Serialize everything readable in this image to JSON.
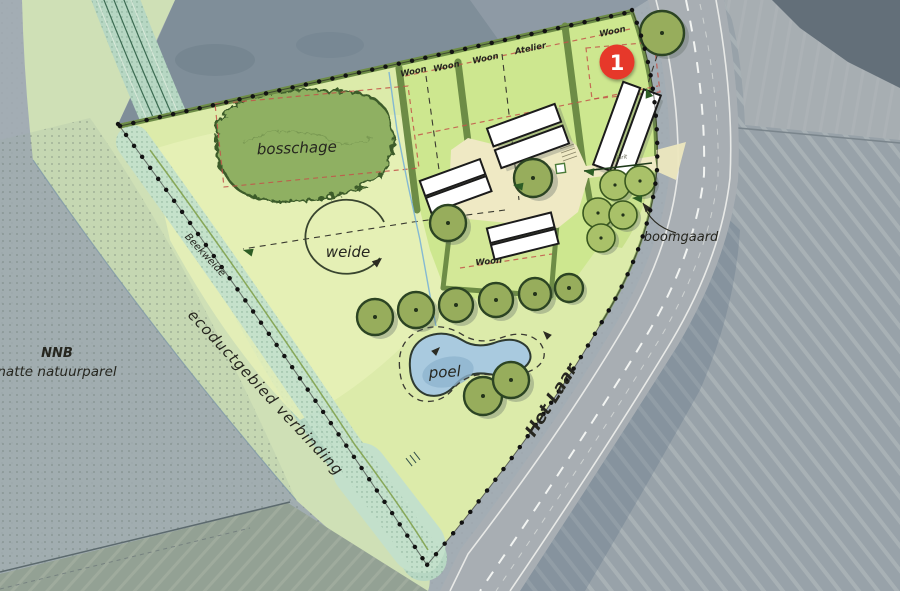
{
  "colors": {
    "badge-red": "#e6372b",
    "site-green": "#dcebaa",
    "plot-green": "#cde78f",
    "meadow-green": "#e7f1b8",
    "corridor-green": "#cfe0b6",
    "stream-teal": "#b7d7c3",
    "bosschage-green": "#8fb062",
    "hedge-green": "#6d8c46",
    "water-blue": "#a9cadf",
    "road-gray": "#a8aeb3",
    "aerial-gray": "#a3adb4",
    "dark-field": "#7f8e99",
    "label-ink": "#26261f"
  },
  "labels": {
    "bosschage": "bosschage",
    "weide": "weide",
    "poel": "poel",
    "boomgaard": "boomgaard",
    "road": "Het Laar",
    "nnb": "NNB",
    "nnb_sub": "natte natuurparel",
    "ecoduct": "ecoductgebied verbinding",
    "stream": "Beekweide",
    "driveway": "inrit",
    "atelier": "Atelier"
  },
  "plots": [
    {
      "label": "Woon"
    },
    {
      "label": "Woon"
    },
    {
      "label": "Woon"
    },
    {
      "label": "Woon"
    },
    {
      "label": "Woon"
    }
  ],
  "marker": {
    "number": "1"
  }
}
